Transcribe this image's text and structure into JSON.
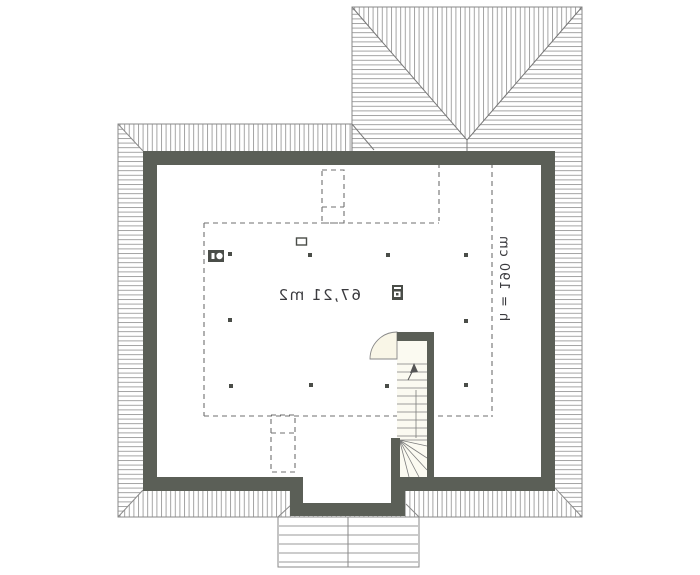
{
  "plan": {
    "type": "attic floor plan (mirrored)",
    "area_label": "67,21 m2",
    "height_label": "h = 190 cm"
  },
  "colors": {
    "wall": "#5b5f57",
    "hatch": "#9a9a9a",
    "outline": "#8a8a8a",
    "dash": "#6f6f6f",
    "symbol": "#4a4d48",
    "door_fill": "#f9f6e7",
    "stair_fill": "#fbfaf1",
    "text": "#3a3a3e"
  }
}
